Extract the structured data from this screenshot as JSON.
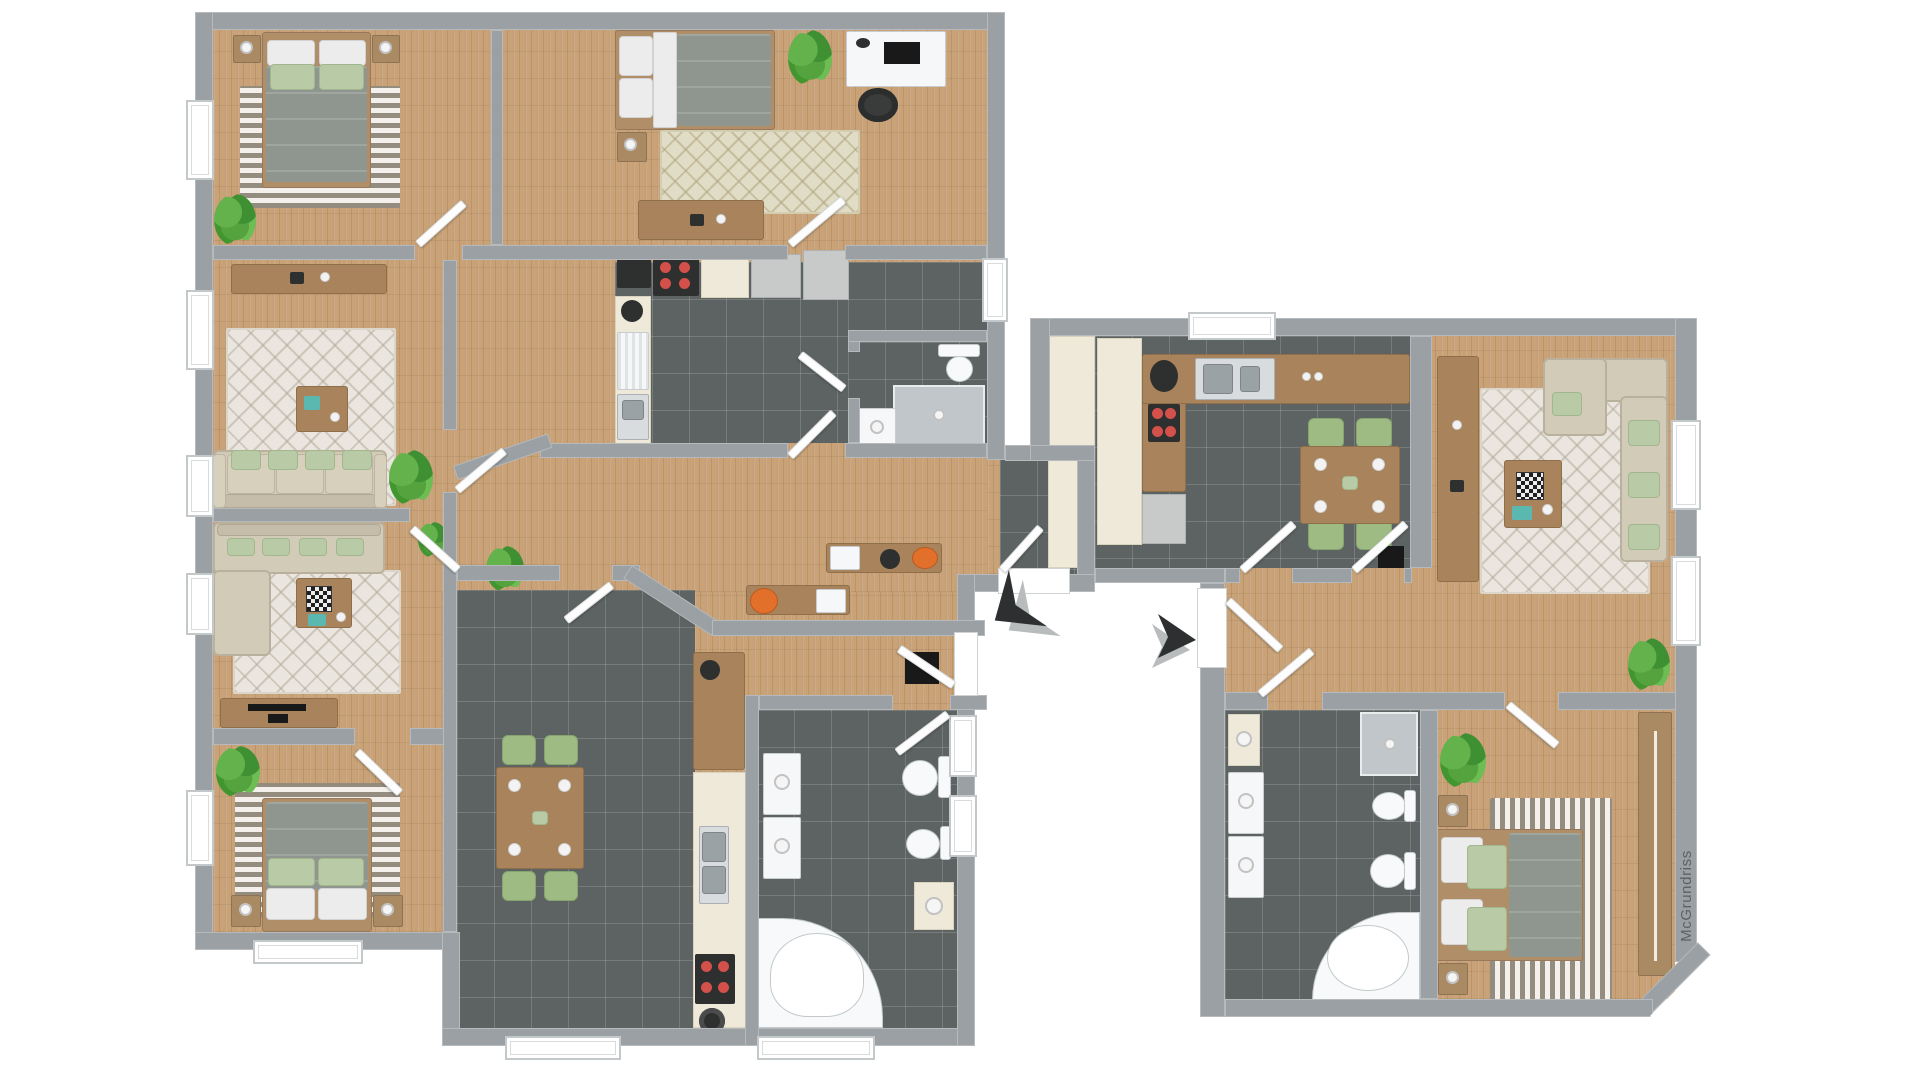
{
  "watermark": {
    "text": "McGrundriss"
  },
  "palette": {
    "background": "#ffffff",
    "walls": "#9aa0a3",
    "wood_floor": "#c9a277",
    "tile_floor": "#5d6362",
    "rug_cream": "#eae6df",
    "rug_stripe_taupe": "#b4aa9c",
    "sofa_beige": "#d2cbb8",
    "pillow_green": "#b9cba6",
    "bed_duvet_gray": "#8f968f",
    "kitchen_cream": "#efe9da",
    "counter_brown": "#a8835c",
    "chair_green": "#9dbb83",
    "stove_burner_red": "#d4504a",
    "appliance_white": "#f6f7f8",
    "plant_green": "#4e9c3f",
    "arrow_dark": "#2d2f30",
    "arrow_light": "#b9bcbd"
  },
  "buildings": [
    {
      "id": "left-building",
      "apartments": [
        {
          "id": "apartment-a",
          "rooms": [
            {
              "name": "bedroom-top-left",
              "furniture": [
                "double-bed",
                "nightstand",
                "nightstand",
                "table-lamp",
                "table-lamp",
                "striped-rug",
                "plant"
              ]
            },
            {
              "name": "bedroom-top-middle",
              "furniture": [
                "single-bed",
                "nightstand",
                "desk",
                "desk-chair",
                "monitor",
                "diamond-rug",
                "sideboard",
                "plant"
              ]
            },
            {
              "name": "living-room-upper",
              "furniture": [
                "sofa",
                "coffee-table",
                "sideboard",
                "diamond-rug",
                "plant"
              ]
            },
            {
              "name": "kitchen",
              "furniture": [
                "cooktop",
                "stove",
                "sink",
                "dishwasher",
                "counter",
                "cabinet",
                "kettle"
              ]
            },
            {
              "name": "bathroom",
              "furniture": [
                "toilet",
                "shower",
                "washing-machine"
              ]
            },
            {
              "name": "hallway-office",
              "furniture": [
                "desk",
                "desk",
                "office-chair",
                "stool",
                "entrance-vestibule"
              ]
            }
          ]
        },
        {
          "id": "apartment-b",
          "rooms": [
            {
              "name": "living-room-lower",
              "furniture": [
                "corner-sofa",
                "coffee-table",
                "chessboard",
                "tv-lowboard",
                "tv",
                "diamond-rug",
                "plant"
              ]
            },
            {
              "name": "bedroom-bottom-left",
              "furniture": [
                "double-bed",
                "nightstand",
                "nightstand",
                "table-lamp",
                "table-lamp",
                "striped-rug",
                "plant"
              ]
            },
            {
              "name": "dining-room",
              "furniture": [
                "dining-table",
                "chair",
                "chair",
                "chair",
                "chair"
              ]
            },
            {
              "name": "kitchenette",
              "furniture": [
                "sink",
                "stove",
                "counter",
                "pot",
                "kettle"
              ]
            },
            {
              "name": "bathroom",
              "furniture": [
                "corner-bathtub",
                "toilet",
                "bidet",
                "vanity",
                "washing-machine",
                "dryer"
              ]
            }
          ]
        }
      ]
    },
    {
      "id": "right-building",
      "apartments": [
        {
          "id": "apartment-c",
          "rooms": [
            {
              "name": "kitchen-dining",
              "furniture": [
                "sink",
                "cooktop",
                "fridge",
                "tall-cabinet",
                "counter",
                "dining-table",
                "chair",
                "chair",
                "chair",
                "chair",
                "entrance-mat"
              ]
            },
            {
              "name": "living-room",
              "furniture": [
                "corner-sofa",
                "coffee-table",
                "chessboard",
                "sideboard",
                "diamond-rug",
                "plant"
              ]
            },
            {
              "name": "hallway",
              "furniture": [
                "plant"
              ]
            },
            {
              "name": "bathroom",
              "furniture": [
                "corner-bathtub",
                "shower",
                "toilet",
                "bidet",
                "vanity",
                "washing-machine",
                "dryer"
              ]
            },
            {
              "name": "bedroom",
              "furniture": [
                "double-bed",
                "nightstand",
                "nightstand",
                "table-lamp",
                "table-lamp",
                "striped-rug",
                "wardrobe",
                "plant"
              ]
            }
          ]
        }
      ]
    }
  ],
  "entrance_arrows": [
    {
      "id": "arrow-to-left-building",
      "direction": "up-left"
    },
    {
      "id": "arrow-to-right-building",
      "direction": "right"
    }
  ]
}
